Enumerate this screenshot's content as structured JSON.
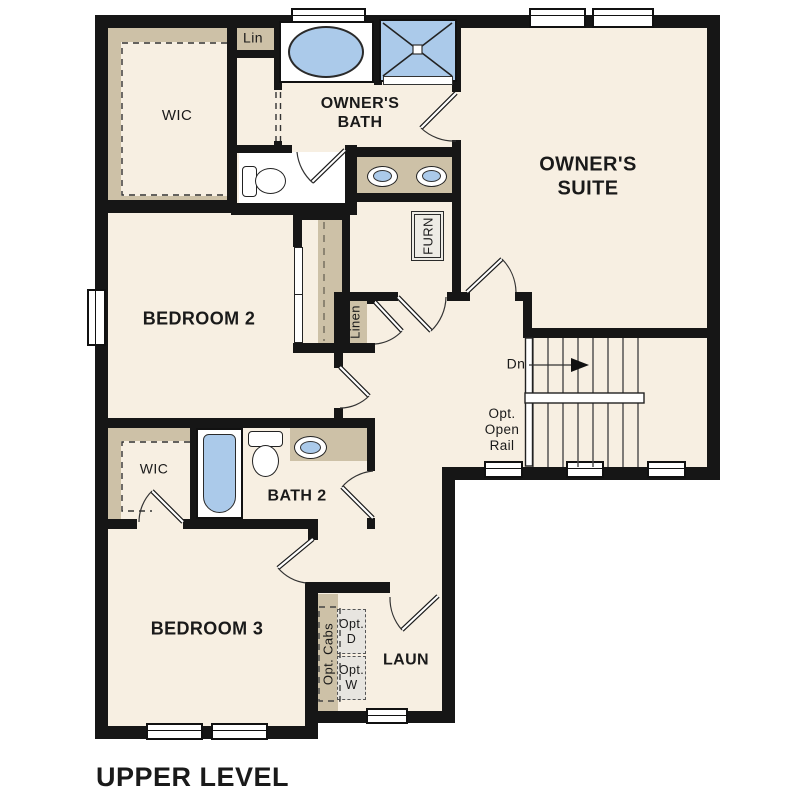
{
  "title": "UPPER LEVEL",
  "rooms": {
    "owners_suite": "OWNER'S\nSUITE",
    "owners_bath": "OWNER'S\nBATH",
    "bedroom2": "BEDROOM 2",
    "bedroom3": "BEDROOM 3",
    "bath2": "BATH 2",
    "laundry": "LAUN",
    "wic_owner": "WIC",
    "wic_bedroom3": "WIC",
    "linen_upper": "Lin",
    "linen_hall": "Linen",
    "furnace": "FURN"
  },
  "annotations": {
    "stairs_down": "Dn",
    "opt_open_rail": "Opt.\nOpen\nRail",
    "opt_cabs": "Opt. Cabs",
    "opt_dryer": "Opt.\nD",
    "opt_washer": "Opt.\nW"
  },
  "colors": {
    "floor": "#f7efe2",
    "casework_tan": "#cdc1a7",
    "fixture_blue": "#abcaea",
    "wall": "#161616",
    "optional_gray": "#e7e5e0",
    "background": "#ffffff"
  }
}
